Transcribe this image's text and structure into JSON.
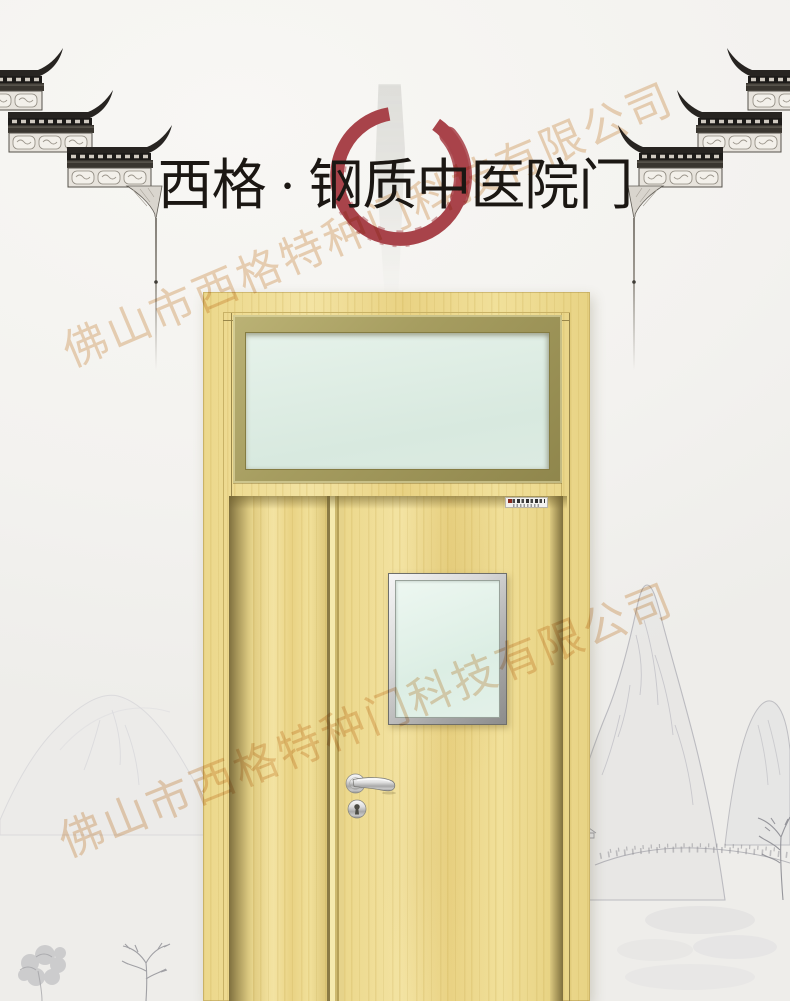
{
  "poster": {
    "title": "西格 · 钢质中医院门",
    "watermark_text": "佛山市西格特种门科技有限公司",
    "colors": {
      "title_ink": "#1b1713",
      "enso_red": "#a8434a",
      "watermark_tan": "#dca76e",
      "door_wood": "#eeda8e",
      "door_wood_grain": "#d9c06c",
      "transom_frame_olive": "#a29a5d",
      "glass_green": "#e0efe7",
      "steel_silver": "#c9c9c9",
      "ink_wash_gray": "#b5b5ba",
      "paper": "#f4f3f0"
    },
    "decor": {
      "eave_left": "traditional-stepped-eave-corner",
      "eave_right": "traditional-stepped-eave-corner-mirrored",
      "enso": "red-brush-circle",
      "gray_stroke": "vertical-ink-brush-stroke",
      "mountains_right": "ink-wash-mountains",
      "hills_left": "faint-ink-hills",
      "trees_bottom": "ink-wash-trees"
    },
    "door": {
      "brand_plate_legible": false
    }
  }
}
